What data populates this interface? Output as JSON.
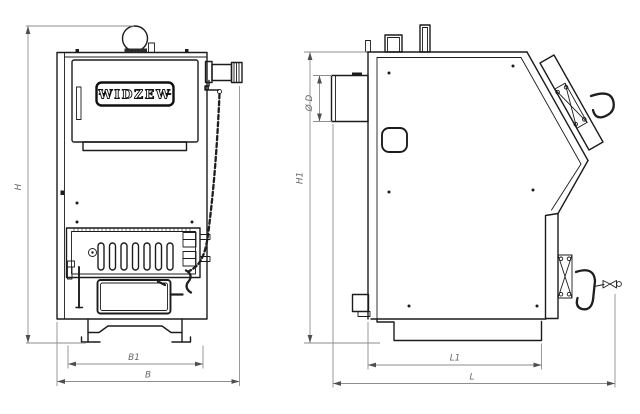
{
  "drawing": {
    "brand_plate": "WIDZEW",
    "front_view": {
      "dim_height": "H",
      "dim_inner_width": "B1",
      "dim_overall_width": "B"
    },
    "side_view": {
      "dim_height": "H1",
      "dim_flue_diameter": "Ø D",
      "dim_inner_depth": "L1",
      "dim_overall_depth": "L"
    },
    "colors": {
      "line": "#1c1c1c",
      "dimension_line": "#8e8e8e",
      "dimension_text": "#676767",
      "background": "#ffffff"
    }
  }
}
